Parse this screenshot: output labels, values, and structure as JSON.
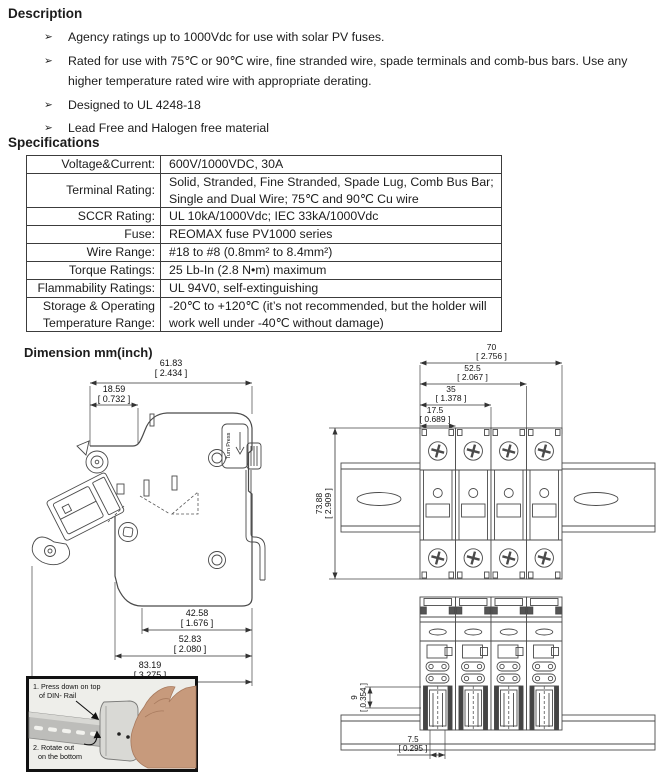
{
  "headings": {
    "description": "Description",
    "specifications": "Specifications",
    "dimension": "Dimension mm(inch)"
  },
  "bullets": {
    "char": "➢",
    "items": [
      "Agency ratings up to 1000Vdc for use with solar PV fuses.",
      "Rated for use with 75℃ or 90℃ wire, fine stranded wire, spade terminals and comb-bus bars. Use any higher temperature rated wire with appropriate derating.",
      "Designed to UL 4248-18",
      "Lead Free and Halogen free material"
    ]
  },
  "spec_table": {
    "rows": [
      {
        "label": "Voltage&Current:",
        "value": "600V/1000VDC, 30A"
      },
      {
        "label": "Terminal Rating:",
        "value": "Solid, Stranded, Fine Stranded, Spade Lug, Comb Bus Bar;\nSingle and Dual Wire; 75℃ and 90℃ Cu wire"
      },
      {
        "label": "SCCR Rating:",
        "value": "UL 10kA/1000Vdc; IEC 33kA/1000Vdc"
      },
      {
        "label": "Fuse:",
        "value": "REOMAX  fuse  PV1000  series"
      },
      {
        "label": "Wire Range:",
        "value": "#18 to #8 (0.8mm² to 8.4mm²)"
      },
      {
        "label": "Torque Ratings:",
        "value": "25 Lb-In (2.8 N•m) maximum"
      },
      {
        "label": "Flammability Ratings:",
        "value": "UL 94V0, self-extinguishing"
      },
      {
        "label": "Storage & Operating Temperature Range:",
        "value": "-20℃ to +120℃  (it’s not recommended, but the holder will\nwork well under -40℃ without damage)"
      }
    ]
  },
  "side_view": {
    "total_mm": "61.83",
    "total_in": "[ 2.434 ]",
    "cover_mm": "18.59",
    "cover_in": "[ 0.732 ]",
    "foot_mm": "42.58",
    "foot_in": "[ 1.676 ]",
    "body_mm": "52.83",
    "body_in": "[ 2.080 ]",
    "overall_mm": "83.19",
    "overall_in": "[ 3.275 ]",
    "tag": "Turn Press"
  },
  "front_view": {
    "p4_mm": "70",
    "p4_in": "[ 2.756 ]",
    "p3_mm": "52.5",
    "p3_in": "[ 2.067 ]",
    "p2_mm": "35",
    "p2_in": "[ 1.378 ]",
    "p1_mm": "17.5",
    "p1_in": "[ 0.689 ]",
    "h_mm": "73.88",
    "h_in": "[ 2.909 ]"
  },
  "bottom_view": {
    "depth_mm": "9",
    "depth_in": "[ 0.354 ]",
    "offset_mm": "7.5",
    "offset_in": "[ 0.295 ]"
  },
  "photo": {
    "s1a": "1. Press down on top",
    "s1b": "of DIN- Rail",
    "s2a": "2. Rotate out",
    "s2b": "on the bottom"
  }
}
